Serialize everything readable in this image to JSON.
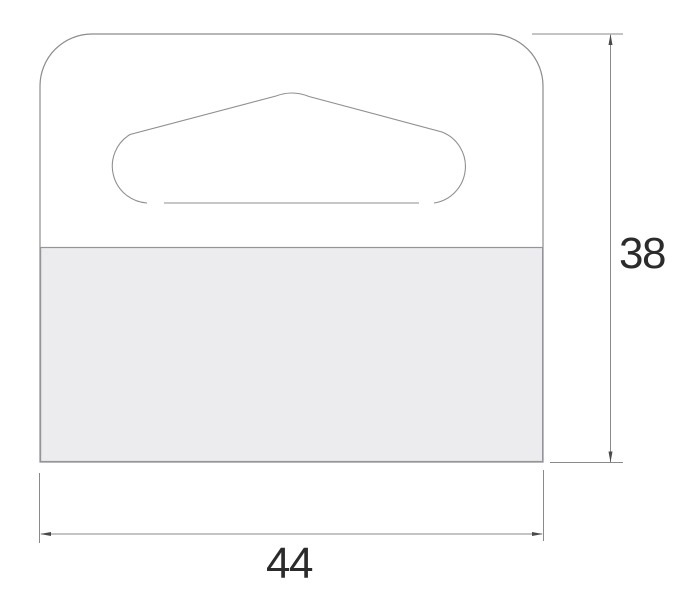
{
  "drawing": {
    "width_dimension": {
      "label": "44"
    },
    "height_dimension": {
      "label": "38"
    }
  },
  "colors": {
    "background": "#ffffff",
    "outline": "#8c8c8c",
    "slot_cut": "#8f8f8f",
    "adhesive_fill": "#ececef",
    "dimension_line": "#8a8a8a",
    "arrowhead": "#4a4a4a",
    "label_text": "#2b2b2b"
  }
}
